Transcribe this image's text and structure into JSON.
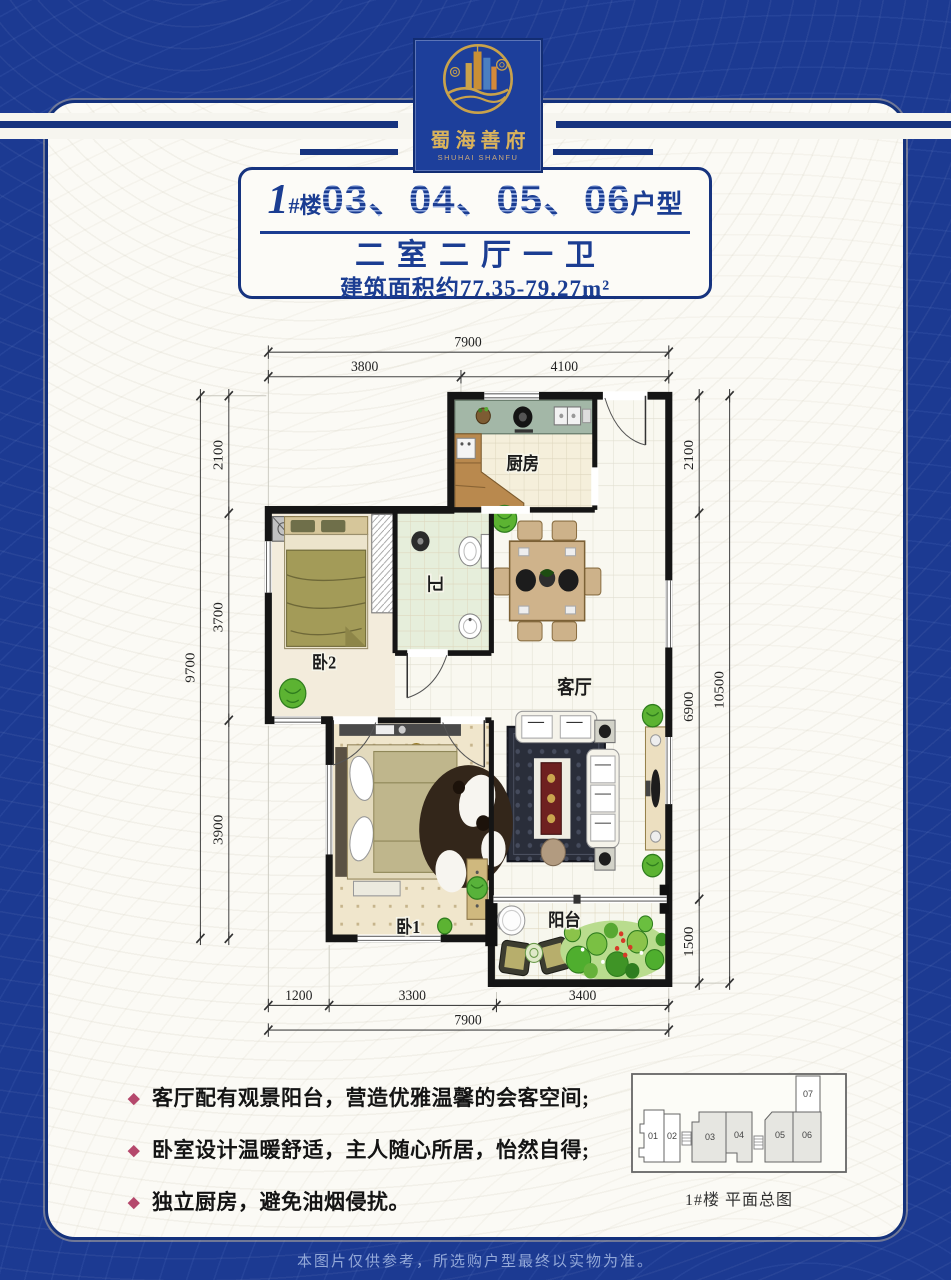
{
  "colors": {
    "navy": "#16337f",
    "royal_blue": "#1d3f9b",
    "gold": "#c9a24b",
    "feature_diamond": "#b5486c",
    "paper": "#fbfaf5"
  },
  "logo": {
    "cn": "蜀海善府",
    "en": "SHUHAI SHANFU"
  },
  "title": {
    "building_no": "1",
    "building_suffix": "#楼",
    "units": "03、04、05、06",
    "type_suffix": "户型",
    "layout": "二室二厅一卫",
    "area": "建筑面积约77.35-79.27m²"
  },
  "rooms": {
    "kitchen": "厨房",
    "bath": "卫",
    "bed2": "卧2",
    "living": "客厅",
    "bed1": "卧1",
    "balcony": "阳台"
  },
  "dims": {
    "top_total": "7900",
    "top_a": "3800",
    "top_b": "4100",
    "left_total": "9700",
    "left_a": "2100",
    "left_b": "3700",
    "left_c": "3900",
    "right_a": "2100",
    "right_b": "6900",
    "right_c": "1500",
    "right_total": "10500",
    "bottom_a": "1200",
    "bottom_b": "3300",
    "bottom_c": "3400",
    "bottom_total": "7900"
  },
  "features": [
    "客厅配有观景阳台，营造优雅温馨的会客空间;",
    "卧室设计温暖舒适，主人随心所居，怡然自得;",
    "独立厨房，避免油烟侵扰。"
  ],
  "overview": {
    "caption": "1#楼 平面总图",
    "units": [
      "01",
      "02",
      "03",
      "04",
      "05",
      "06",
      "07"
    ]
  },
  "footer": "本图片仅供参考，所选购户型最终以实物为准。"
}
